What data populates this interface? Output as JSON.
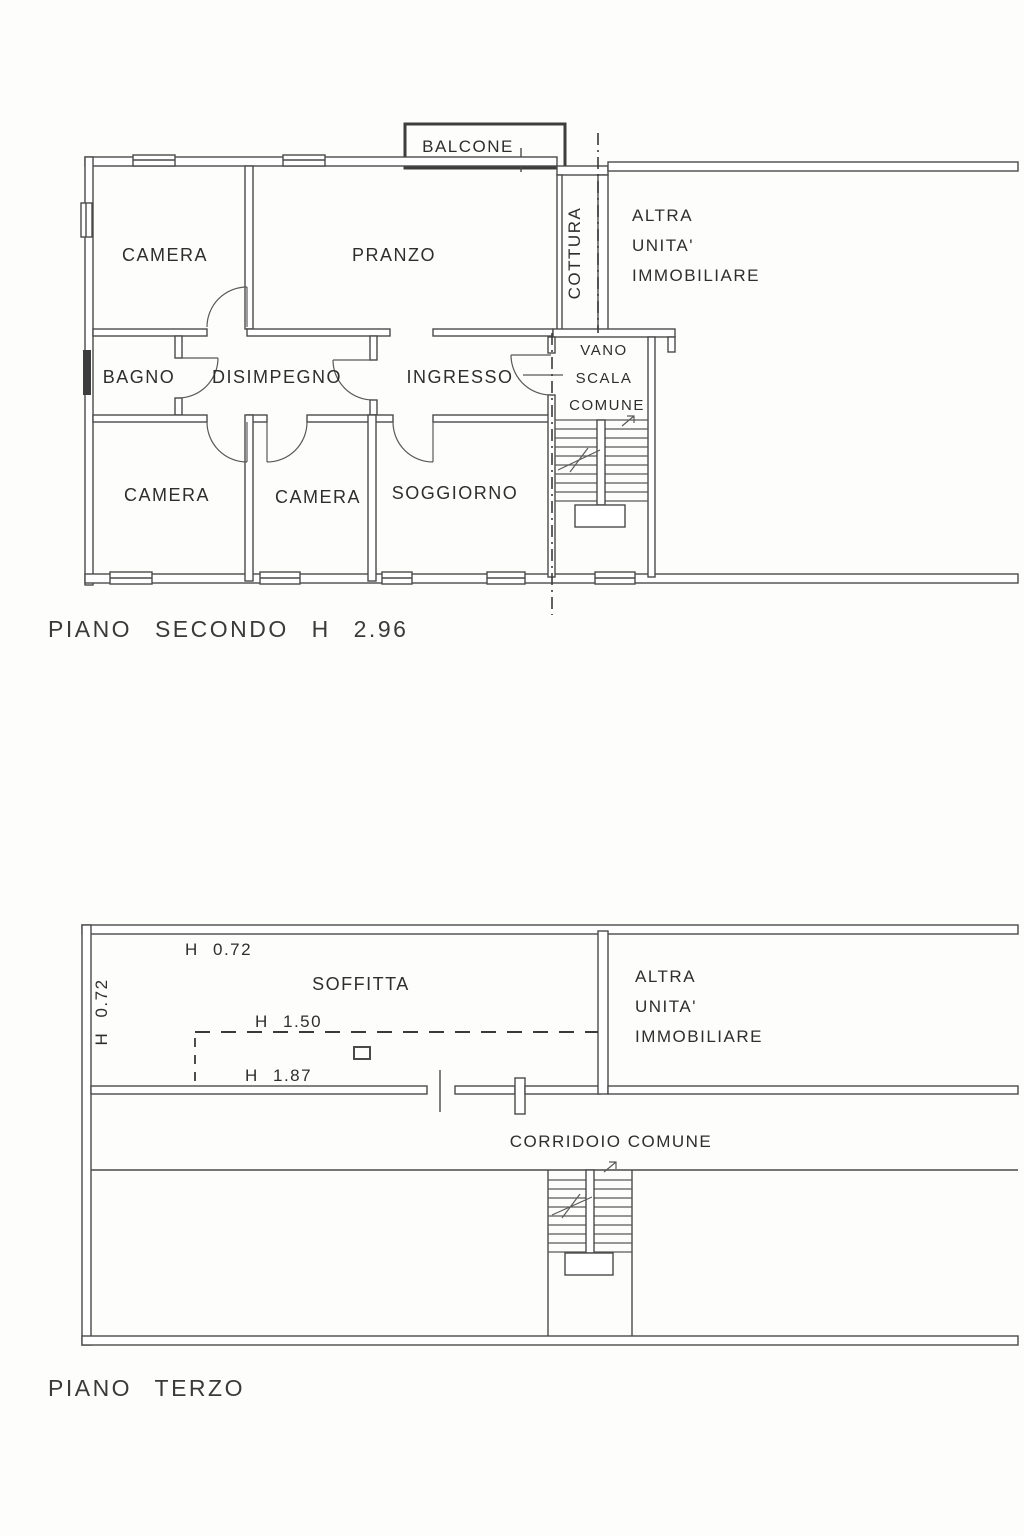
{
  "document": {
    "type": "floor-plan-drawing",
    "line_color": "#4a4a4a",
    "text_color": "#2e2e2e",
    "background": "#fdfdfb"
  },
  "plan2": {
    "title": "PIANO SECONDO H 2.96",
    "balcone": "BALCONE",
    "camera_nw": "CAMERA",
    "pranzo": "PRANZO",
    "cottura": "COTTURA",
    "altra": [
      "ALTRA",
      "UNITA'",
      "IMMOBILIARE"
    ],
    "bagno": "BAGNO",
    "disimpegno": "DISIMPEGNO",
    "ingresso": "INGRESSO",
    "vano": [
      "VANO",
      "SCALA",
      "COMUNE"
    ],
    "camera_sw": "CAMERA",
    "camera_s": "CAMERA",
    "soggiorno": "SOGGIORNO"
  },
  "plan3": {
    "title": "PIANO TERZO",
    "h_top": "H 0.72",
    "h_left": "H 0.72",
    "soffitta": "SOFFITTA",
    "h_mid": "H 1.50",
    "h_low": "H 1.87",
    "altra": [
      "ALTRA",
      "UNITA'",
      "IMMOBILIARE"
    ],
    "corridoio": "CORRIDOIO COMUNE"
  }
}
